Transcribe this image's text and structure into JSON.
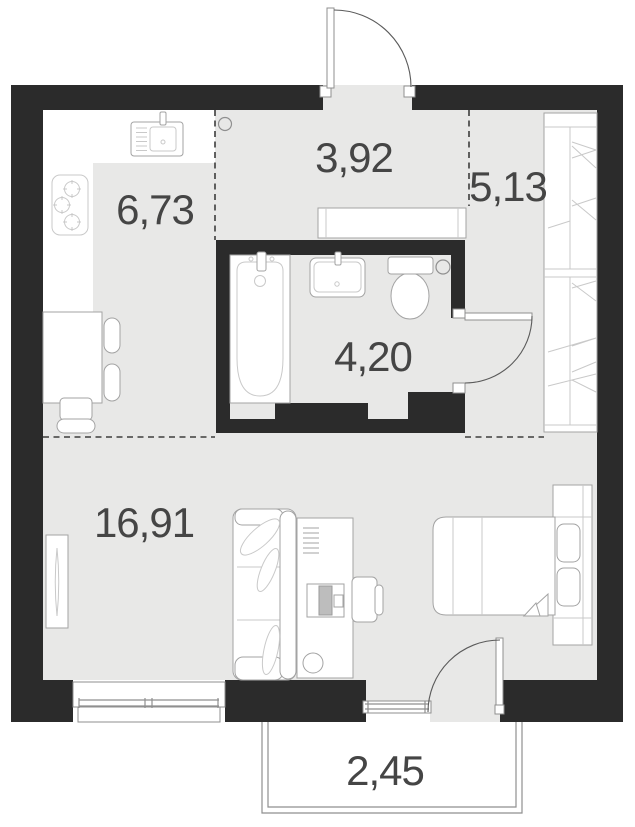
{
  "plan": {
    "type": "apartment-floor-plan",
    "rooms": [
      {
        "id": "kitchen",
        "area": "6,73"
      },
      {
        "id": "hallway",
        "area": "3,92"
      },
      {
        "id": "dressing",
        "area": "5,13"
      },
      {
        "id": "bathroom",
        "area": "4,20"
      },
      {
        "id": "living-room",
        "area": "16,91"
      },
      {
        "id": "balcony",
        "area": "2,45"
      }
    ],
    "colors": {
      "wall": "#2b2b2b",
      "floor": "#e8e8e7",
      "furniture_outline": "#a3a3a3",
      "label_text": "#454545"
    },
    "icons": [
      "kitchen-sink-icon",
      "stove-icon",
      "dining-table-icon",
      "chair-icon",
      "hallway-shelf-icon",
      "wardrobe-icon",
      "bathtub-icon",
      "washbasin-icon",
      "toilet-icon",
      "floor-drain-icon",
      "ceiling-light-icon",
      "tv-icon",
      "sofa-icon",
      "desk-icon",
      "computer-icon",
      "stool-icon",
      "desk-chair-icon",
      "bed-icon",
      "entrance-door-swing-icon",
      "bathroom-door-swing-icon",
      "balcony-door-swing-icon",
      "window-icon",
      "balcony-window-icon"
    ]
  }
}
